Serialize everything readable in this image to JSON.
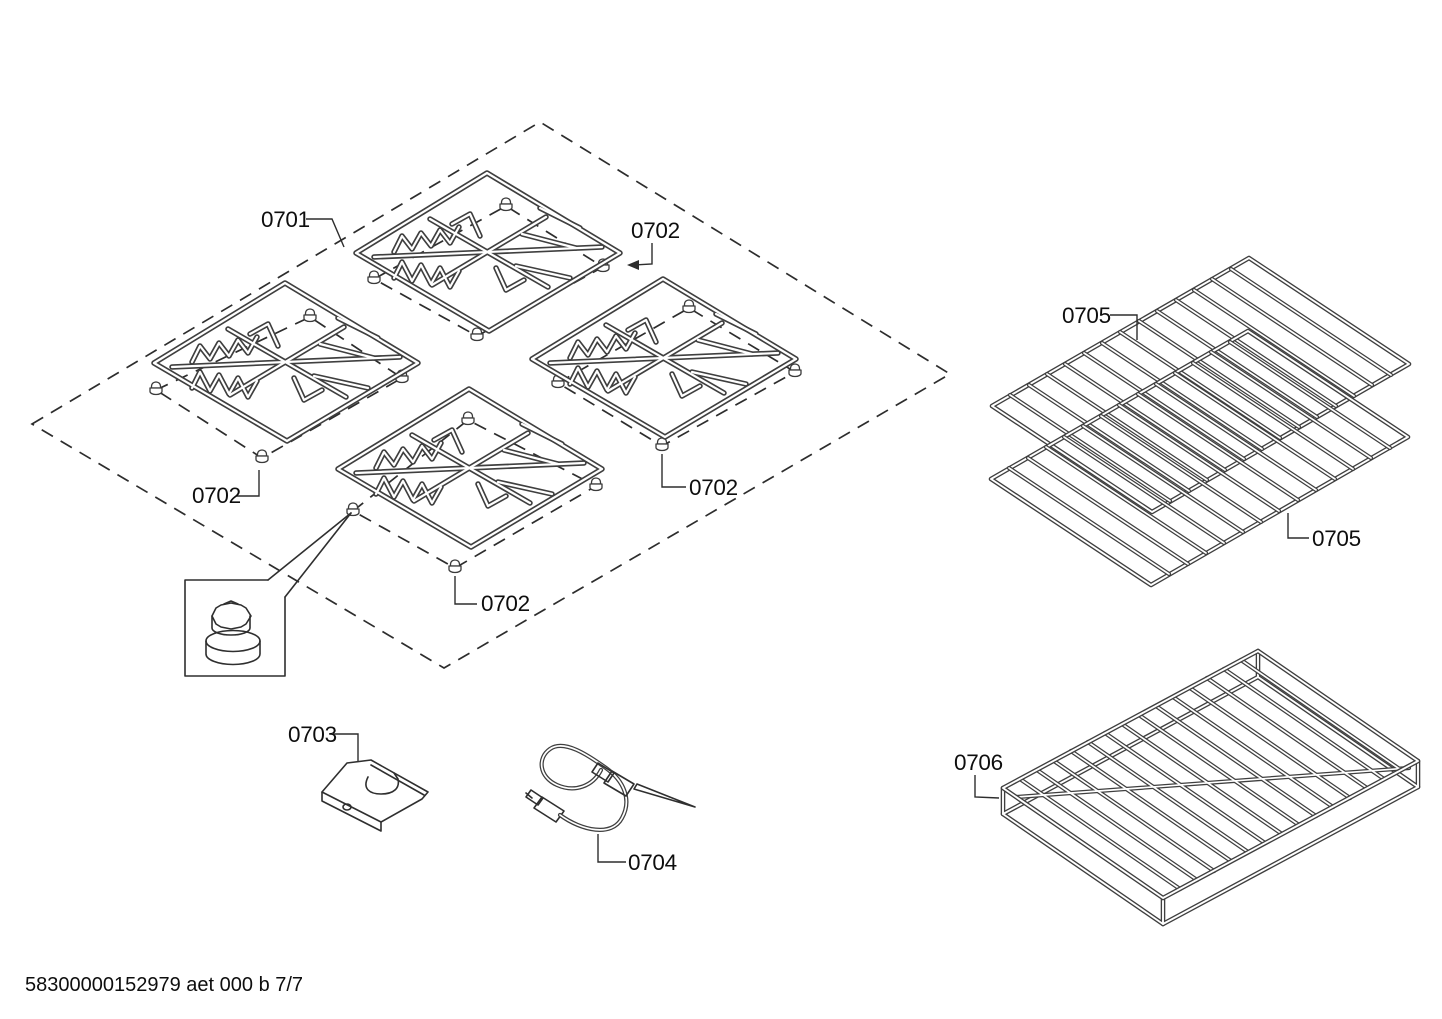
{
  "document": {
    "footer_code": "58300000152979 aet 000 b 7/7"
  },
  "callouts": {
    "c0701": "0701",
    "c0702_top_right": "0702",
    "c0702_left": "0702",
    "c0702_center_right": "0702",
    "c0702_bottom": "0702",
    "c0703": "0703",
    "c0704": "0704",
    "c0705_upper": "0705",
    "c0705_lower": "0705",
    "c0706": "0706"
  }
}
